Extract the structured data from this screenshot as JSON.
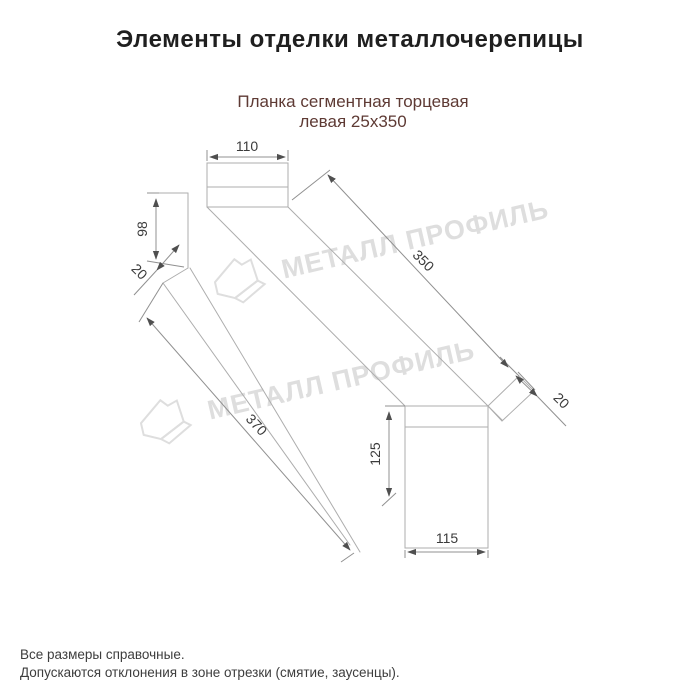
{
  "title": "Элементы отделки металлочерепицы",
  "subtitle": {
    "line1": "Планка сегментная торцевая",
    "line2": "левая 25х350"
  },
  "drawing": {
    "dimensions": {
      "top_width": "110",
      "left_height": "98",
      "left_fold": "20",
      "top_length": "350",
      "right_fold": "20",
      "bottom_length": "370",
      "right_height": "125",
      "bottom_width": "115"
    },
    "watermark_text": "МЕТАЛЛ ПРОФИЛЬ",
    "colors": {
      "structure_line": "#adadad",
      "dimension_line": "#909090",
      "dimension_text": "#3b3b3b",
      "subtitle_text": "#5e3a34",
      "watermark": "#d6d6d6"
    }
  },
  "notes": {
    "line1": "Все размеры справочные.",
    "line2": "Допускаются отклонения в зоне отрезки (смятие, заусенцы)."
  }
}
